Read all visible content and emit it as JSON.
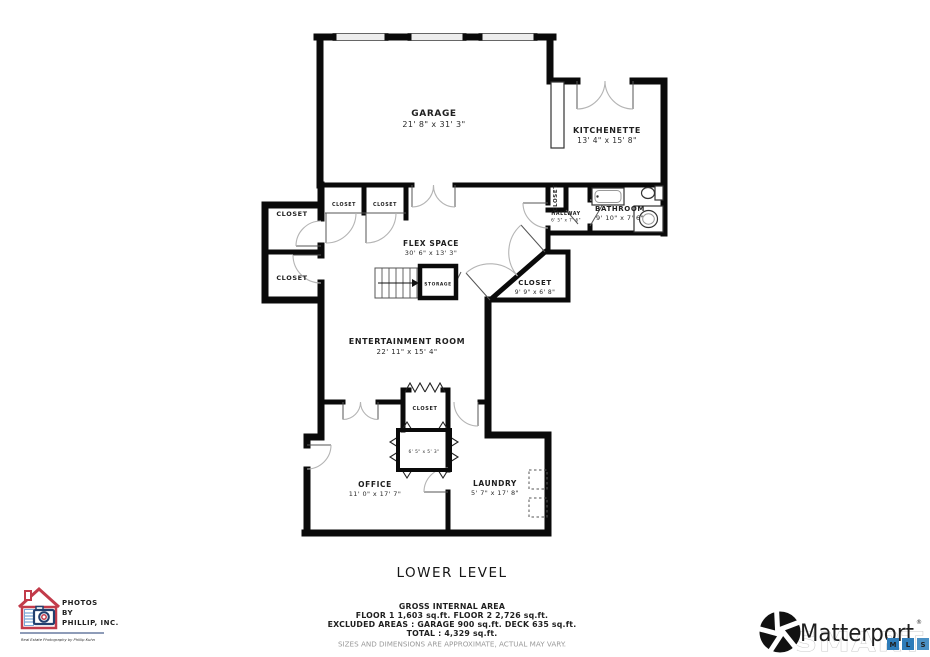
{
  "page_title": "LOWER LEVEL",
  "rooms": {
    "garage": {
      "name": "GARAGE",
      "dims": "21' 8\" x 31' 3\""
    },
    "kitchenette": {
      "name": "KITCHENETTE",
      "dims": "13' 4\" x 15' 8\""
    },
    "bathroom": {
      "name": "BATHROOM",
      "dims": "9' 10\" x 7' 6\""
    },
    "hallway": {
      "name": "HALLWAY",
      "dims": "6' 5\" x 7' 6\""
    },
    "hall_closet": {
      "name": "CLOSET"
    },
    "flex_space": {
      "name": "FLEX SPACE",
      "dims": "30' 6\" x 13' 3\""
    },
    "storage": {
      "name": "STORAGE"
    },
    "angled_closet": {
      "name": "CLOSET",
      "dims": "9' 9\" x 6' 8\""
    },
    "entertainment": {
      "name": "ENTERTAINMENT ROOM",
      "dims": "22' 11\" x 15' 4\""
    },
    "left_closet_upper": {
      "name": "CLOSET"
    },
    "left_closet_lower": {
      "name": "CLOSET"
    },
    "top_closet_left": {
      "name": "CLOSET"
    },
    "top_closet_right": {
      "name": "CLOSET"
    },
    "center_closet": {
      "name": "CLOSET"
    },
    "small_room": {
      "dims": "6' 5\" x 5' 3\""
    },
    "office": {
      "name": "OFFICE",
      "dims": "11' 0\" x 17' 7\""
    },
    "laundry": {
      "name": "LAUNDRY",
      "dims": "5' 7\" x 17' 8\""
    }
  },
  "footer": {
    "area_heading": "GROSS INTERNAL AREA",
    "floors_line": "FLOOR 1 1,603 sq.ft.    FLOOR 2 2,726 sq.ft.",
    "excluded_line": "EXCLUDED AREAS :   GARAGE 900 sq.ft.   DECK 635 sq.ft.",
    "total_line": "TOTAL :  4,329 sq.ft.",
    "disclaimer": "SIZES AND DIMENSIONS ARE APPROXIMATE, ACTUAL MAY VARY."
  },
  "branding": {
    "photographer": {
      "line1": "PHOTOS",
      "line2": "BY",
      "line3": "PHILLIP, INC.",
      "tagline": "Real Estate Photography by Phillip Kuhn"
    },
    "matterport": {
      "wordmark": "Matterport",
      "registered": "®",
      "watermark": "SMART",
      "mls": [
        "M",
        "L",
        "S"
      ]
    }
  },
  "icons": {
    "bathtub": "bathtub-icon",
    "toilet": "toilet-icon",
    "sink": "sink-icon",
    "stairs": "stairs-icon",
    "appliances": "washer-dryer-dashed-boxes",
    "camera_house": "photos-by-phillip-house-camera-icon",
    "pinwheel": "matterport-pinwheel-icon"
  },
  "colors": {
    "wall": "#0a0a0a",
    "door_arc": "#b4b4b4",
    "window_fill": "#ededed",
    "logo_navy": "#1e3a70",
    "logo_red": "#c23b4a",
    "mls_blue": "#2e7cb9",
    "smart_gray": "#c9c9c9",
    "disclaimer_gray": "#9a9a9a"
  }
}
